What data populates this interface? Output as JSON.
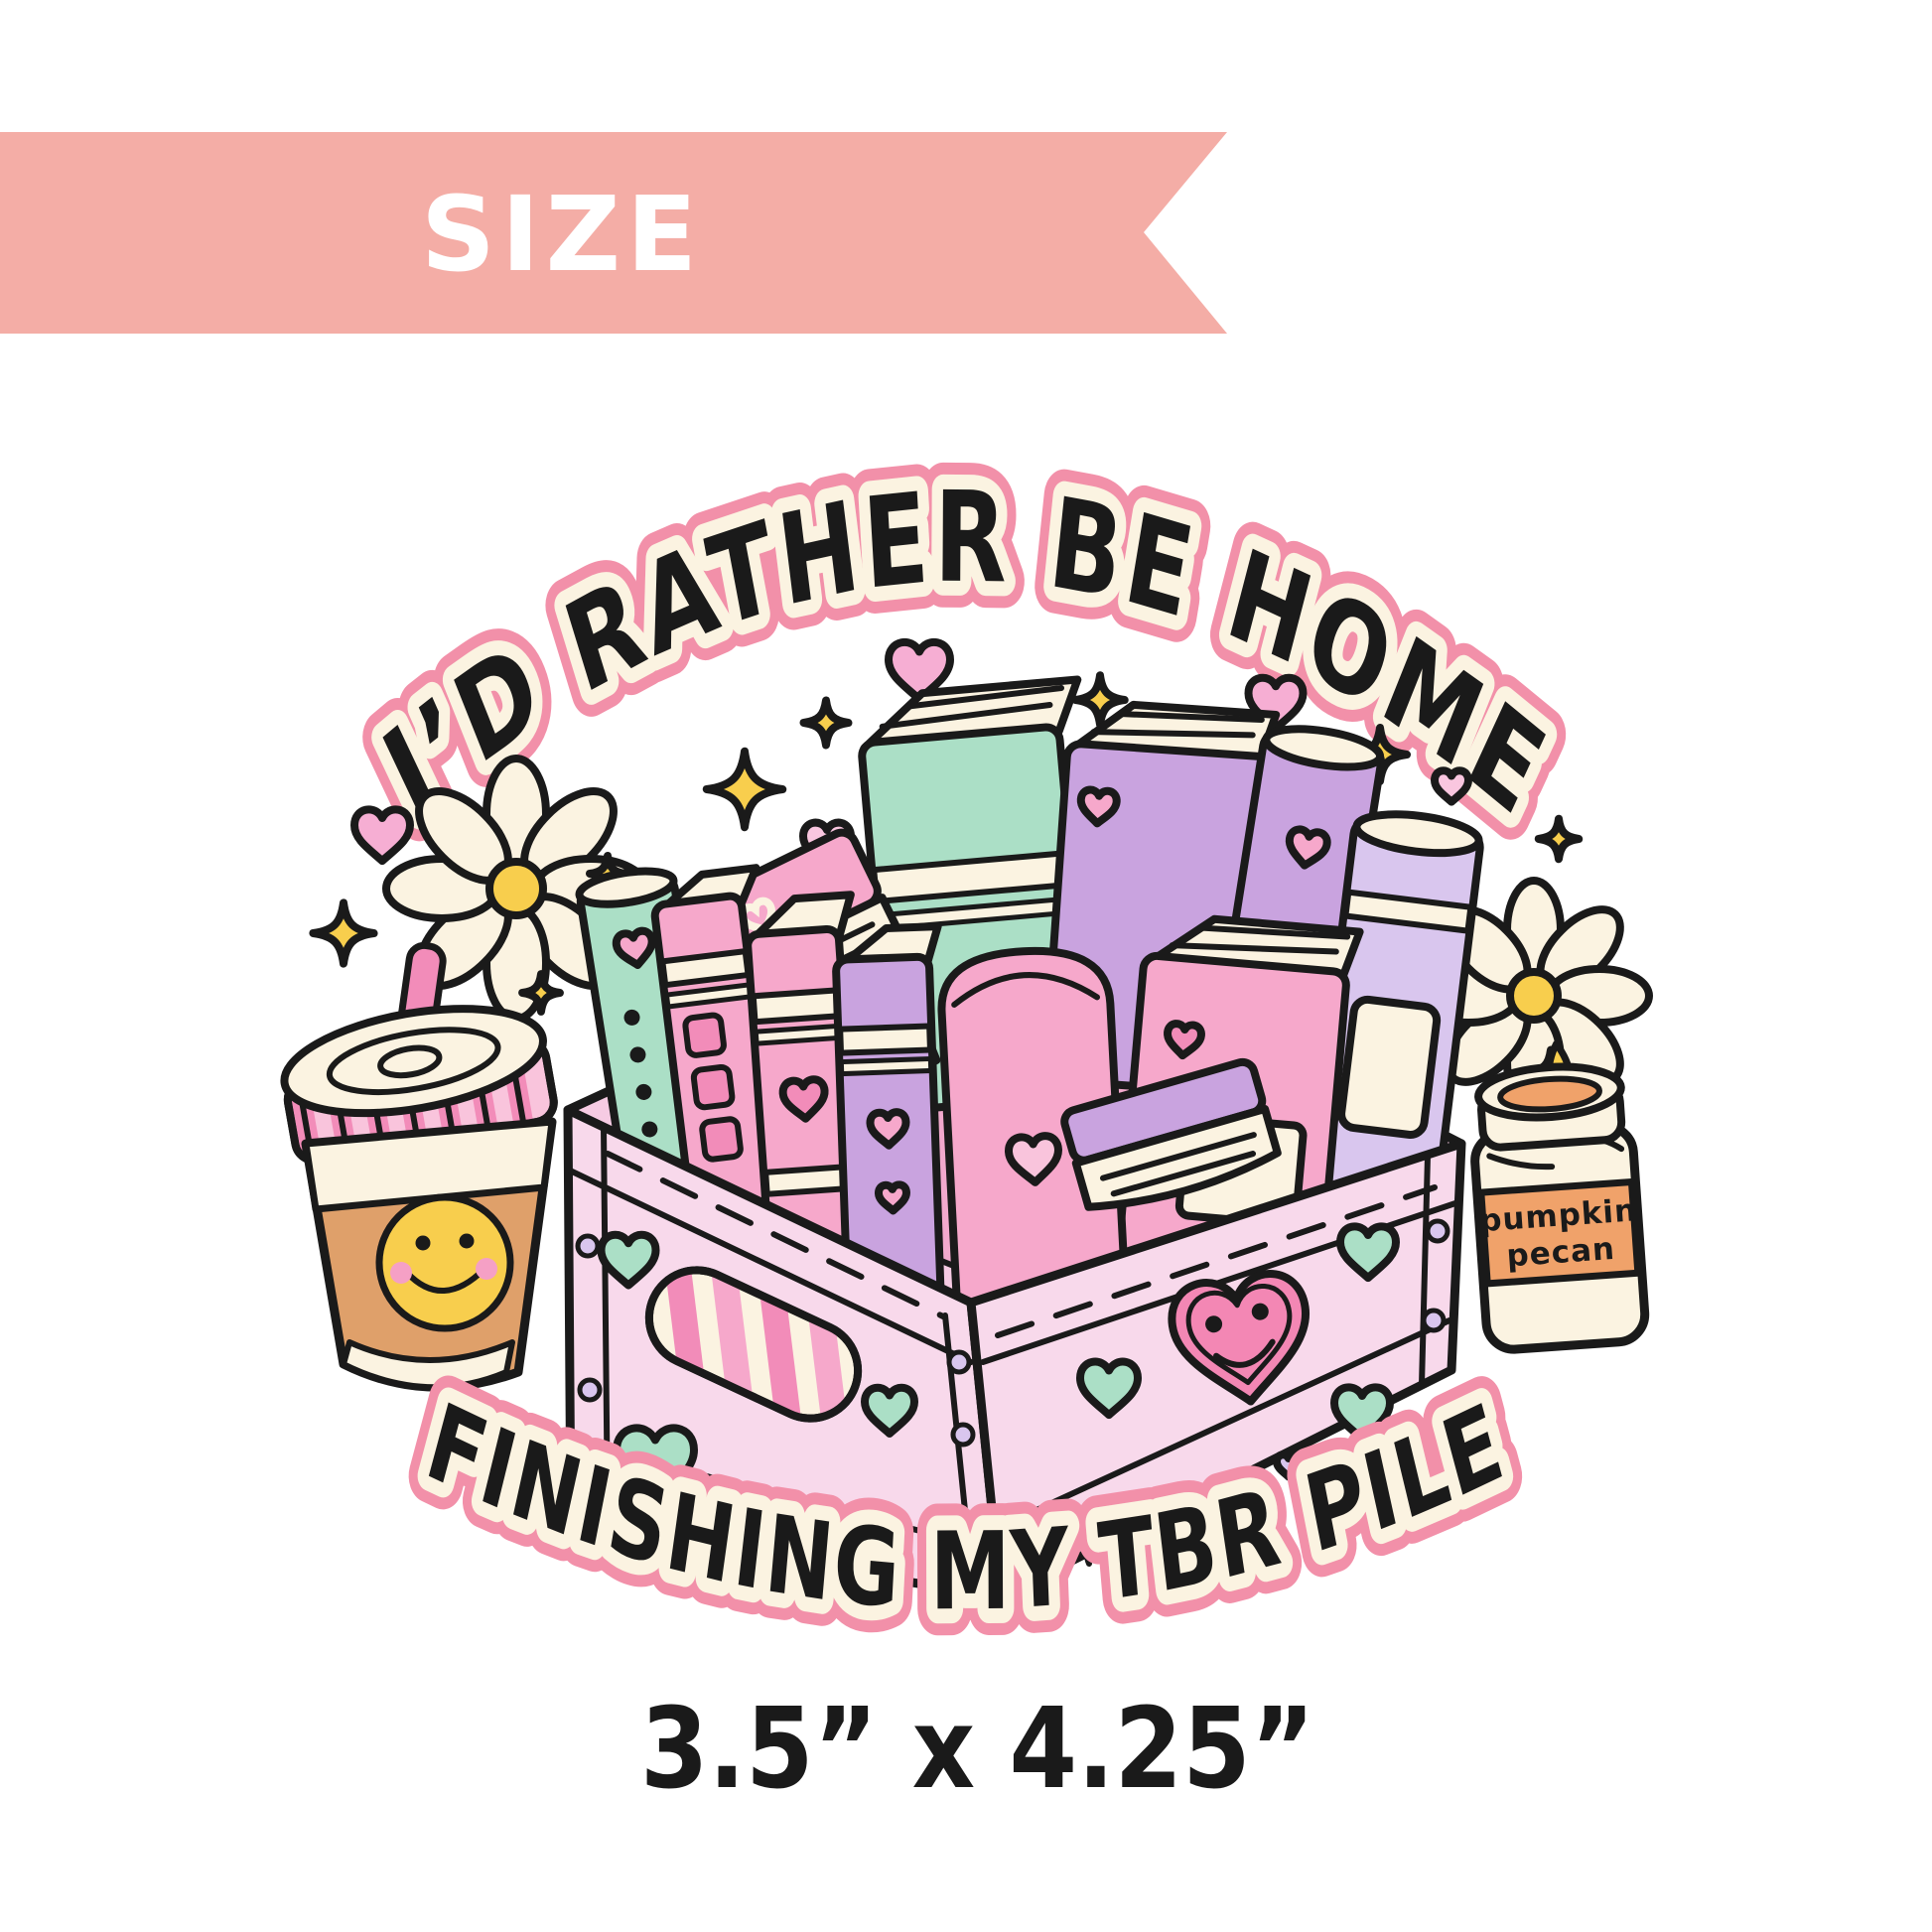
{
  "banner": {
    "label": "SIZE"
  },
  "sticker": {
    "top_text": "I’D RATHER BE HOME",
    "bottom_text": "FINISHING MY TBR PILE",
    "candle_label": {
      "line1": "pumpkin",
      "line2": "pecan"
    }
  },
  "size_label": "3.5” x 4.25”",
  "colors": {
    "banner_pink": "#F4ADA6",
    "ink": "#1A1A1A",
    "cream": "#FBF3E1",
    "text_outline_pink": "#F290A9",
    "heart_pink": "#F6AED3",
    "heart_pink_light": "#F9C6DF",
    "smiley_heart_pink": "#F387B4",
    "mint": "#ABDFC6",
    "lavender": "#D9C6EE",
    "book_pink": "#F6A8CB",
    "book_pink_light": "#F9C4DC",
    "book_pink_dark": "#F28CB9",
    "book_purple": "#C9A3DF",
    "crate_pink": "#F8D9EB",
    "crate_pink_mid": "#F6CBE3",
    "crate_pink_deep": "#F2A9CD",
    "yellow": "#F8CE4D",
    "caramel": "#DFA06A",
    "candle_orange": "#F0A26A",
    "cheek_pink": "#F5A0C5"
  }
}
